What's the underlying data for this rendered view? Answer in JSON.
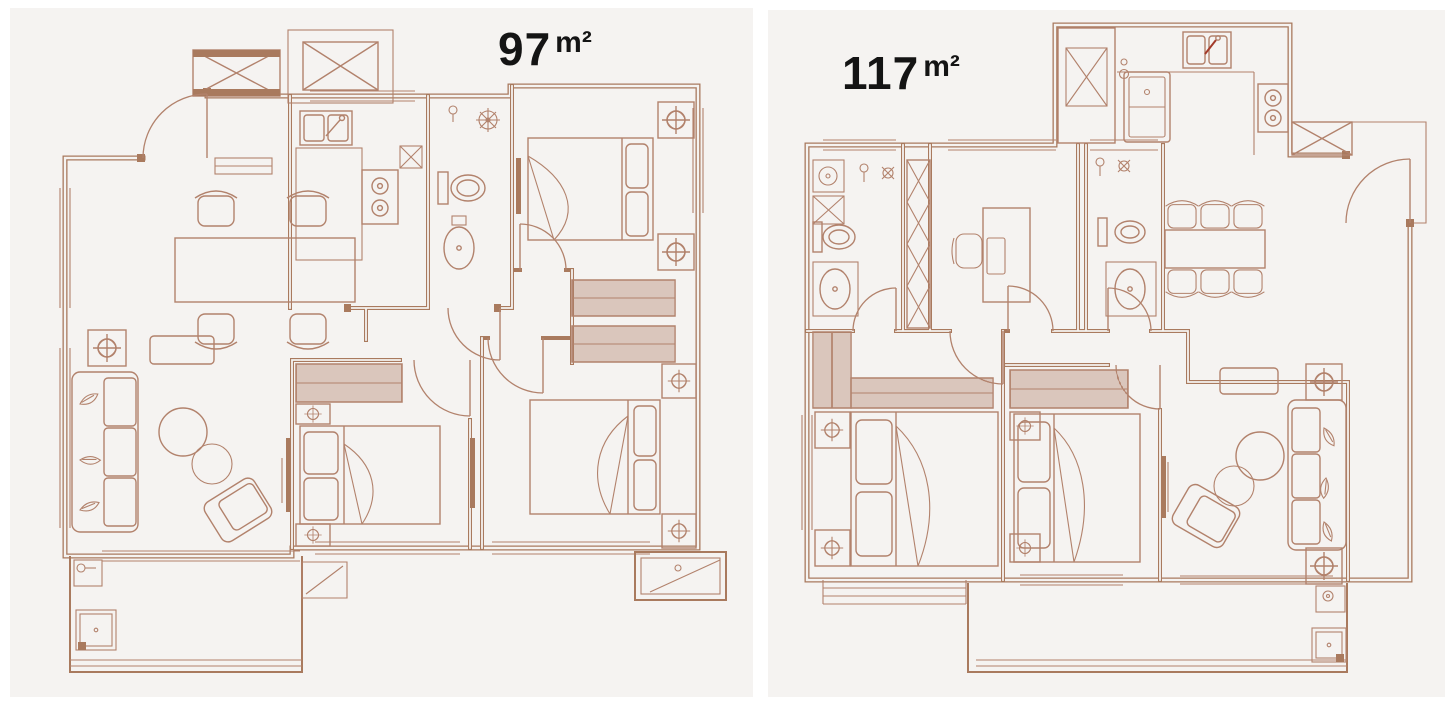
{
  "page": {
    "background_color": "#ffffff"
  },
  "palette": {
    "panel_background": "#f5f3f1",
    "line": "#b2826c",
    "wall": "#a97a5e",
    "label_text": "#141414",
    "faucet_accent": "#a33b2a"
  },
  "panels": [
    {
      "name": "floor-plan-97",
      "area_label": {
        "value": "97",
        "unit": "m²"
      }
    },
    {
      "name": "floor-plan-117",
      "area_label": {
        "value": "117",
        "unit": "m²"
      }
    }
  ]
}
